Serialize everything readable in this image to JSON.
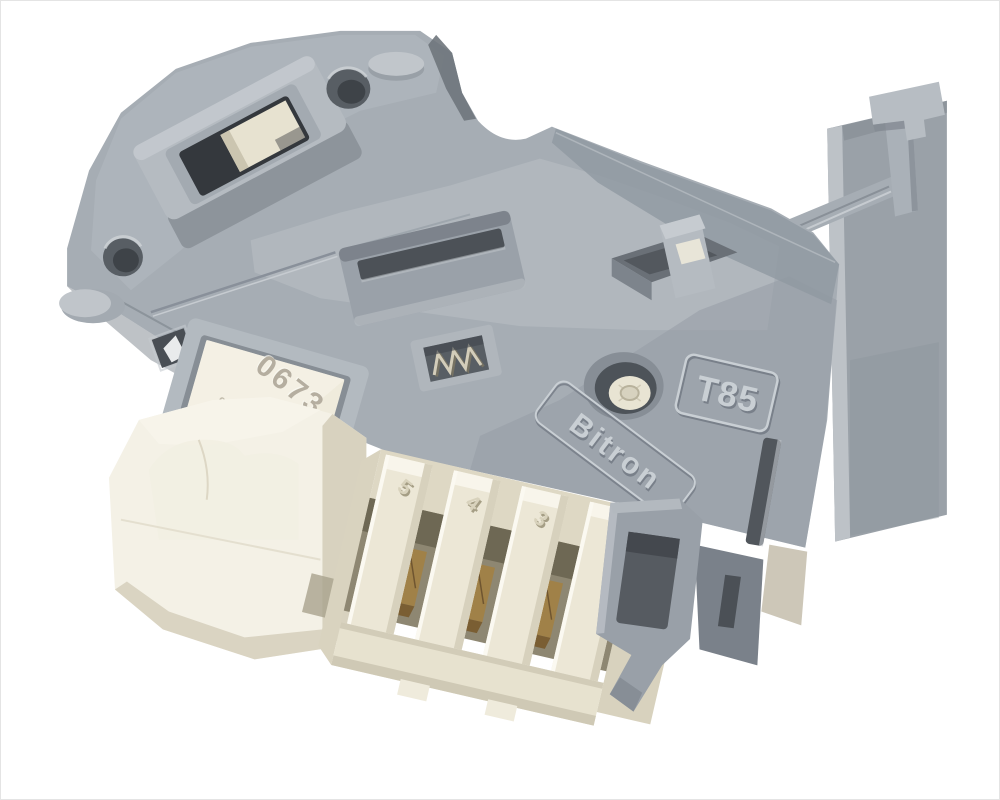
{
  "scene": {
    "subject": "Washing machine door interlock lock switch assembly, three-quarter product photo on white background",
    "background_color": "#ffffff"
  },
  "markings": {
    "badge_model": "T85",
    "brand_logo": "Bitron",
    "label_code": "0673",
    "label_code_secondary": "9.01.5",
    "pin_labels": [
      "5",
      "4",
      "3"
    ]
  },
  "colors": {
    "background": "#ffffff",
    "grey_light": "#b9bfc4",
    "grey_mid": "#a6adb4",
    "grey_body": "#9aa1a8",
    "grey_dark": "#858c94",
    "grey_shadow": "#6b7178",
    "recess_dark": "#4c5157",
    "aperture_dark": "#34383d",
    "cream_light": "#f4f1e6",
    "cream": "#ece7d6",
    "cream_shadow": "#d8d2bf",
    "cavity_brown": "#8e8772",
    "brass": "#a08148",
    "brass_dark": "#6f5530",
    "brass_light": "#caa969",
    "label_bg": "#efebdc",
    "label_text": "#b5aea0",
    "emboss_light": "#c9cfd4",
    "emboss_dark": "#79808a"
  }
}
